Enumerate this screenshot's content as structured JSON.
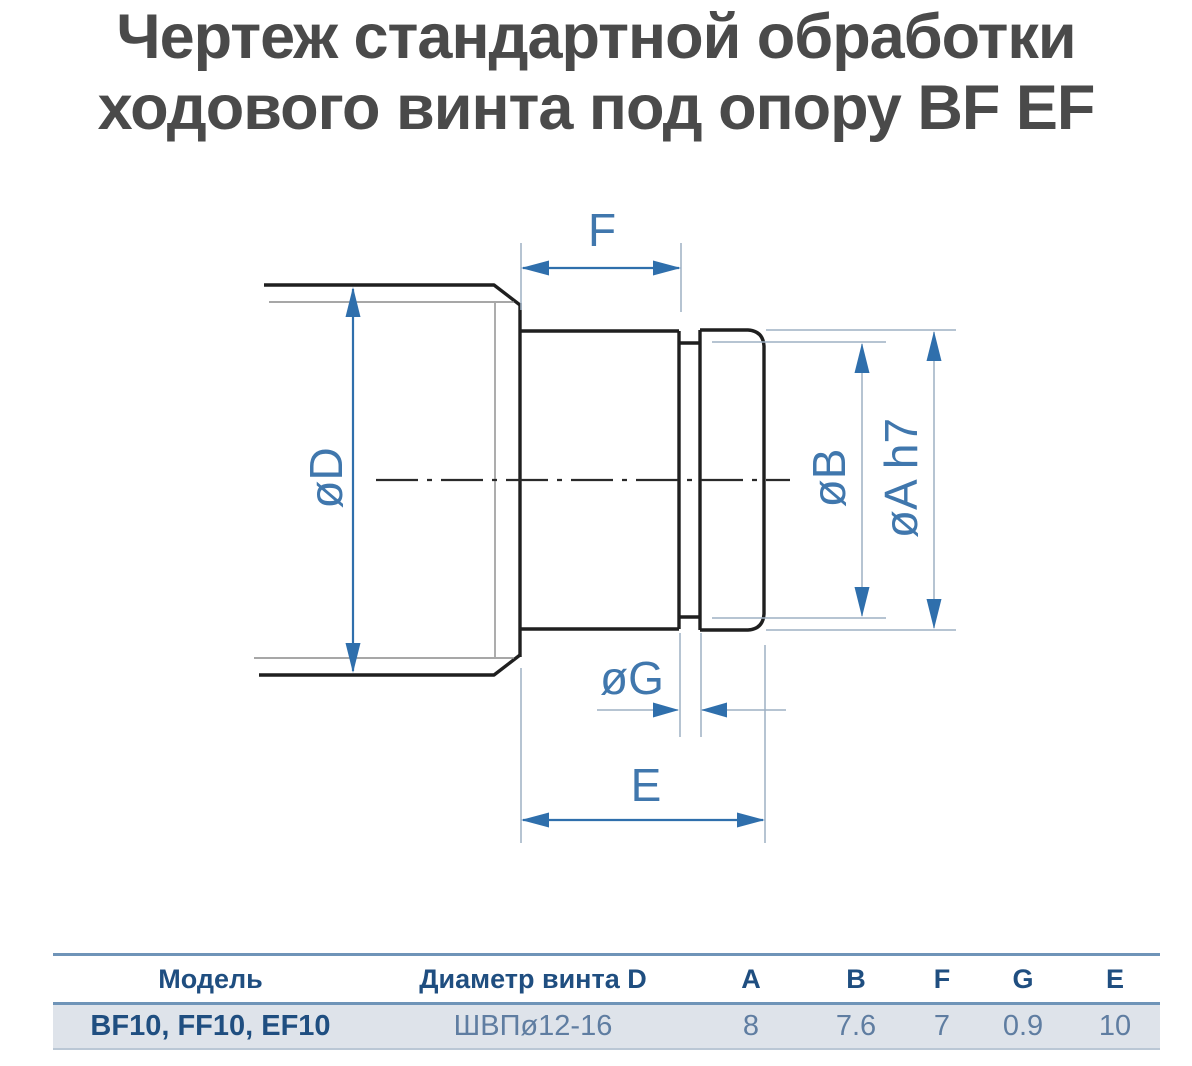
{
  "title": {
    "line1": "Чертеж стандартной обработки",
    "line2": "ходового винта под опору BF EF"
  },
  "drawing": {
    "labels": {
      "f": "F",
      "d": "øD",
      "b": "øB",
      "a": "øA h7",
      "g": "øG",
      "e": "E"
    }
  },
  "table": {
    "headers": [
      "Модель",
      "Диаметр винта D",
      "A",
      "B",
      "F",
      "G",
      "E"
    ],
    "rows": [
      [
        "BF10, FF10, EF10",
        "ШВПø12-16",
        "8",
        "7.6",
        "7",
        "0.9",
        "10"
      ]
    ]
  },
  "colors": {
    "title_text": "#4a4a4a",
    "outline": "#1f1f1f",
    "thin_line": "#8a8a8a",
    "dimension_blue": "#2f6fac",
    "dimension_label_blue": "#4077ab",
    "extension_line": "#9db0c3",
    "table_border_blue": "#6f94b8",
    "table_header_text": "#1f4e80",
    "table_value_text": "#5f7da1",
    "table_row_bg": "#dee3ea"
  }
}
